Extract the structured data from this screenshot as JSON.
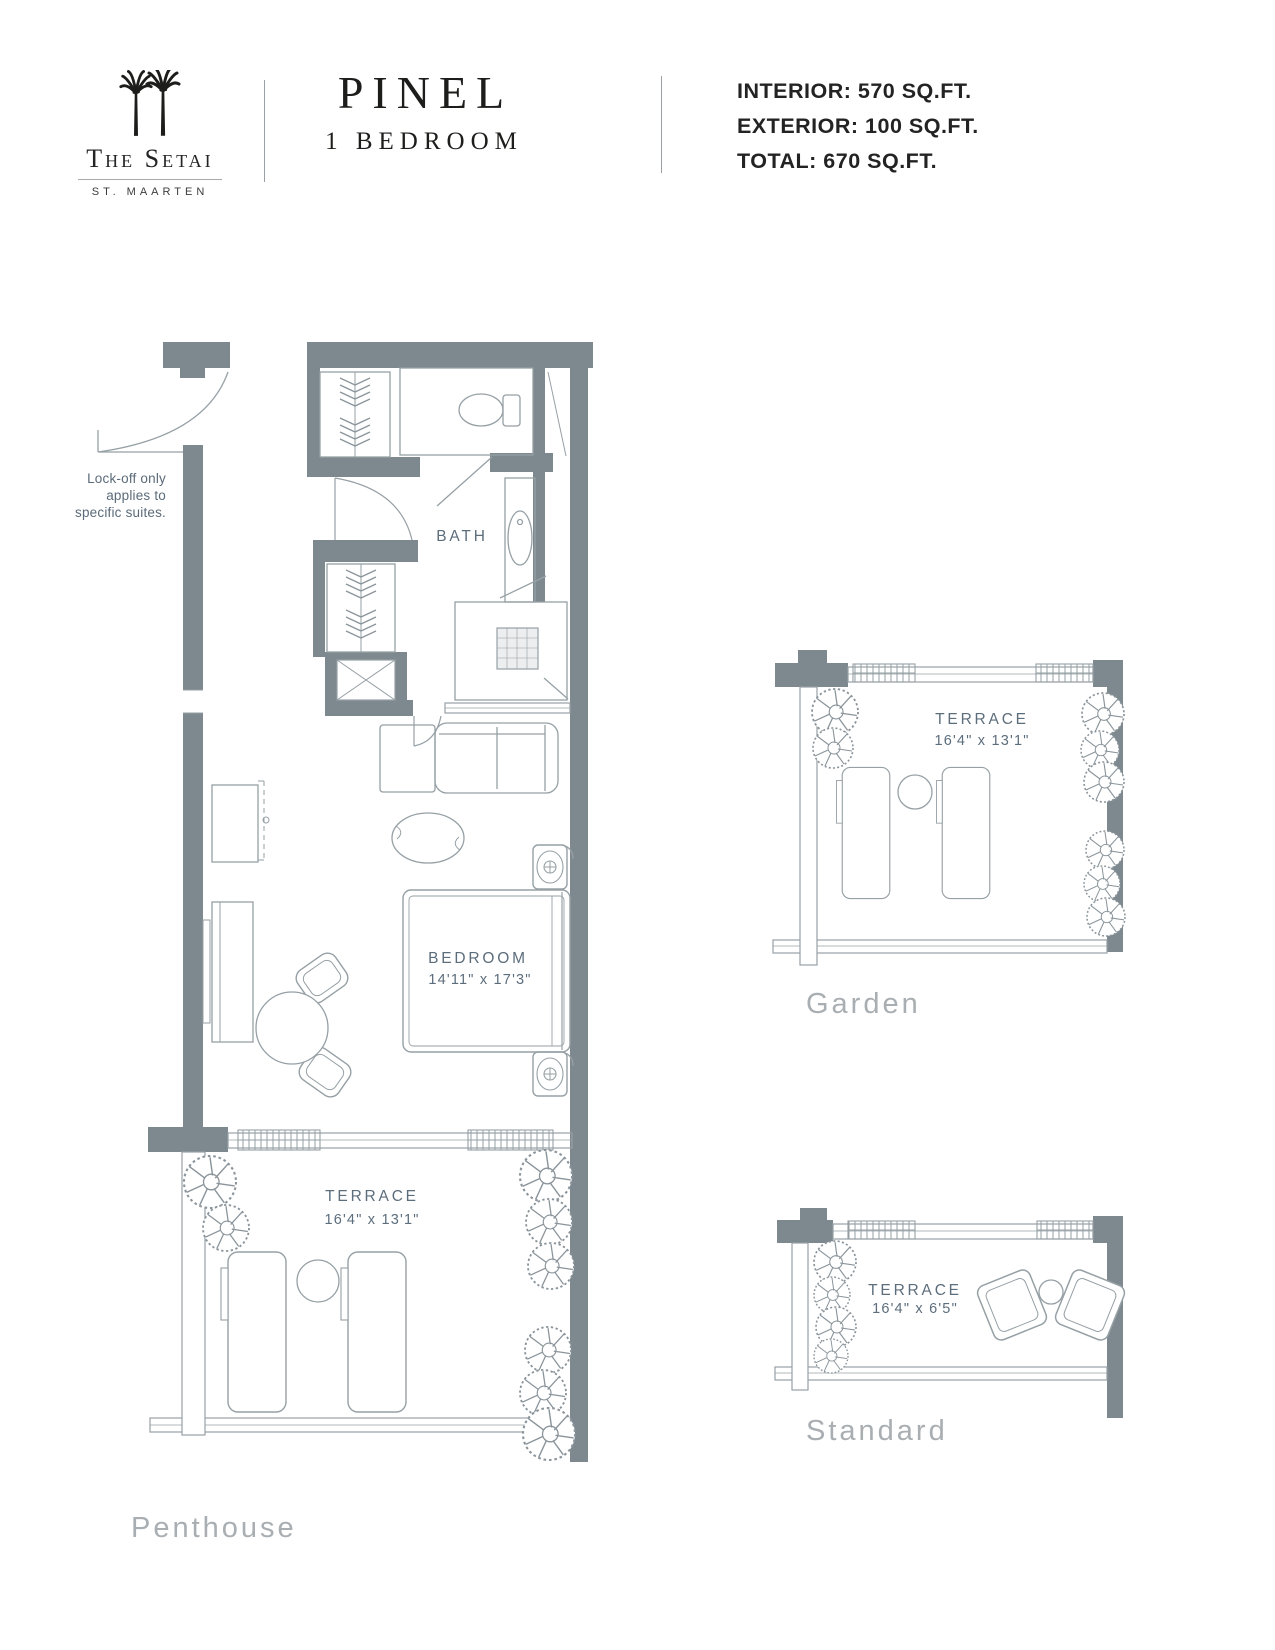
{
  "header": {
    "brand": "The Setai",
    "location": "ST. MAARTEN",
    "title": "PINEL",
    "subtitle": "1 BEDROOM",
    "stats": {
      "interior": "INTERIOR: 570 SQ.FT.",
      "exterior": "EXTERIOR: 100 SQ.FT.",
      "total": "TOTAL: 670 SQ.FT."
    }
  },
  "note": {
    "line1": "Lock-off only",
    "line2": "applies to",
    "line3": "specific suites."
  },
  "plan": {
    "bath_label": "BATH",
    "bedroom": {
      "label": "BEDROOM",
      "dims": "14'11\" x 17'3\""
    },
    "penthouse": {
      "terrace_label": "TERRACE",
      "dims": "16'4\" x 13'1\"",
      "floor_label": "Penthouse"
    },
    "garden": {
      "terrace_label": "TERRACE",
      "dims": "16'4\" x 13'1\"",
      "floor_label": "Garden"
    },
    "standard": {
      "terrace_label": "TERRACE",
      "dims": "16'4\" x 6'5\"",
      "floor_label": "Standard"
    }
  },
  "colors": {
    "wall": "#7d898f",
    "furniture_line": "#96a0a5",
    "room_label": "#5c6d7c",
    "floor_label": "#a9aeb2",
    "header_text": "#232323"
  }
}
